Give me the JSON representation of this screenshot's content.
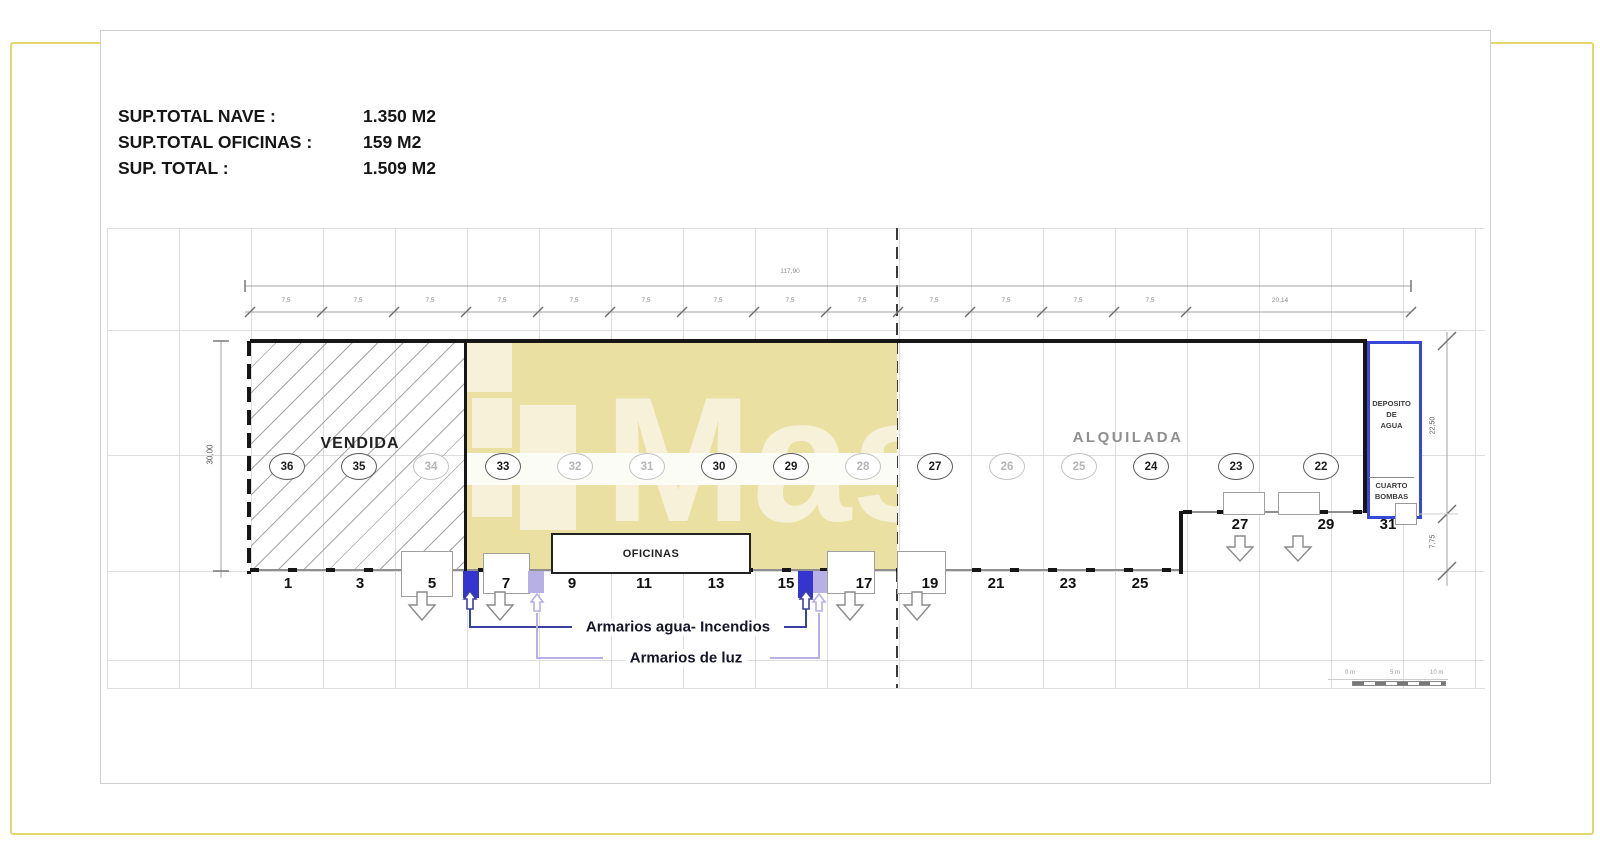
{
  "summary": {
    "rows": [
      {
        "label": "SUP.TOTAL NAVE :",
        "value": "1.350 M2"
      },
      {
        "label": "SUP.TOTAL OFICINAS :",
        "value": "159 M2"
      },
      {
        "label": "SUP. TOTAL :",
        "value": "1.509 M2"
      }
    ]
  },
  "plan": {
    "zone_labels": {
      "vendida": "VENDIDA",
      "alquilada": "ALQUILADA",
      "oficinas": "OFICINAS"
    },
    "deposito_lines": [
      "DEPOSITO",
      "DE",
      "AGUA"
    ],
    "cuarto_lines": [
      "CUARTO",
      "BOMBAS"
    ],
    "bay_circles": [
      {
        "n": "36",
        "faded": false
      },
      {
        "n": "35",
        "faded": false
      },
      {
        "n": "34",
        "faded": true
      },
      {
        "n": "33",
        "faded": false
      },
      {
        "n": "32",
        "faded": true
      },
      {
        "n": "31",
        "faded": true
      },
      {
        "n": "30",
        "faded": false
      },
      {
        "n": "29",
        "faded": false
      },
      {
        "n": "28",
        "faded": true
      },
      {
        "n": "27",
        "faded": false
      },
      {
        "n": "26",
        "faded": true
      },
      {
        "n": "25",
        "faded": true
      },
      {
        "n": "24",
        "faded": false
      },
      {
        "n": "23",
        "faded": false
      },
      {
        "n": "22",
        "faded": false
      }
    ],
    "door_numbers": [
      "1",
      "3",
      "5",
      "7",
      "9",
      "11",
      "13",
      "15",
      "17",
      "19",
      "21",
      "23",
      "25"
    ],
    "step_door_numbers": [
      "27",
      "29",
      "31"
    ],
    "dimensions": {
      "total_width": "117,90",
      "bay_width": "7,5",
      "last_segment": "20,14",
      "height_total": "30,00",
      "height_upper": "22,50",
      "height_lower": "7,75"
    },
    "legend": {
      "agua": "Armarios agua- Incendios",
      "luz": "Armarios de luz"
    },
    "watermark_text": "Mas",
    "scale_bar": {
      "labels": [
        "0 m",
        "5 m",
        "10 m"
      ]
    },
    "colors": {
      "highlight_yellow": "#e9e0a2",
      "frame_yellow": "#e4d76d",
      "armarios_agua_blue": "#3434cf",
      "armarios_agua_line": "#3b3f9e",
      "armarios_luz_purple": "#b6b0e4",
      "deposito_border_blue": "#3947d6"
    }
  }
}
